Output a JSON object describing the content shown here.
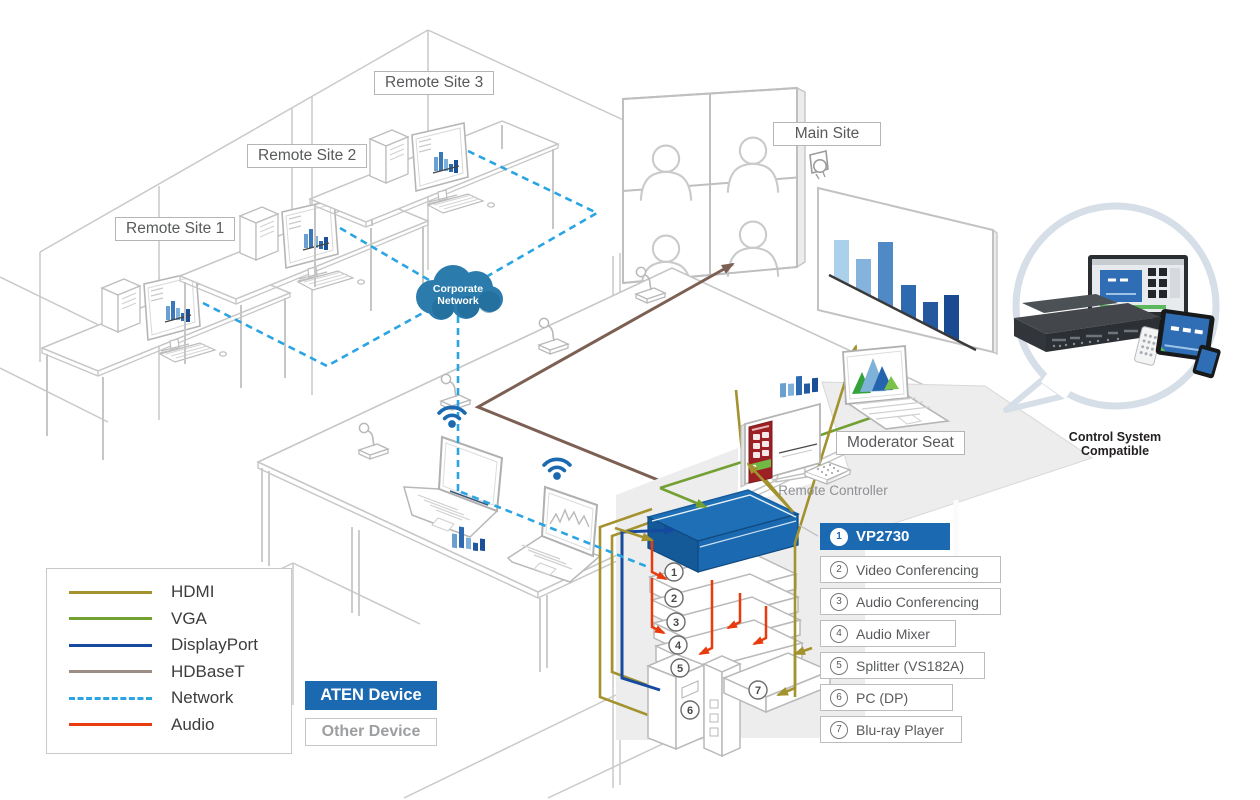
{
  "labels": {
    "remote_sites": [
      {
        "label": "Remote Site 1"
      },
      {
        "label": "Remote Site 2"
      },
      {
        "label": "Remote Site 3"
      }
    ],
    "main_site": "Main Site",
    "moderator_seat": "Moderator Seat",
    "remote_controller": "Remote Controller",
    "control_system": "Control System Compatible",
    "cloud_line1": "Corporate",
    "cloud_line2": "Network"
  },
  "equipment": {
    "items": [
      {
        "num": "1",
        "label": "VP2730",
        "highlight": true
      },
      {
        "num": "2",
        "label": "Video Conferencing"
      },
      {
        "num": "3",
        "label": "Audio Conferencing"
      },
      {
        "num": "4",
        "label": "Audio Mixer"
      },
      {
        "num": "5",
        "label": "Splitter (VS182A)"
      },
      {
        "num": "6",
        "label": "PC (DP)"
      },
      {
        "num": "7",
        "label": "Blu-ray Player"
      }
    ]
  },
  "legend": {
    "items": [
      {
        "label": "HDMI",
        "color": "#a3922d",
        "dashed": false
      },
      {
        "label": "VGA",
        "color": "#74a033",
        "dashed": false
      },
      {
        "label": "DisplayPort",
        "color": "#164a9e",
        "dashed": false
      },
      {
        "label": "HDBaseT",
        "color": "#9c8d85",
        "dashed": false
      },
      {
        "label": "Network",
        "color": "#2aa4e2",
        "dashed": true
      },
      {
        "label": "Audio",
        "color": "#e83c0f",
        "dashed": false
      }
    ]
  },
  "device_key": {
    "aten": "ATEN Device",
    "other": "Other Device"
  },
  "colors": {
    "aten_blue": "#1b6ab1",
    "hdmi": "#a3922d",
    "vga": "#74a033",
    "displayport": "#164a9e",
    "hdbaset": "#7d6054",
    "network": "#2aa4e2",
    "audio": "#e83c0f",
    "outline_gray": "#c6c6c6",
    "cloud_blue": "#2b7cad"
  }
}
